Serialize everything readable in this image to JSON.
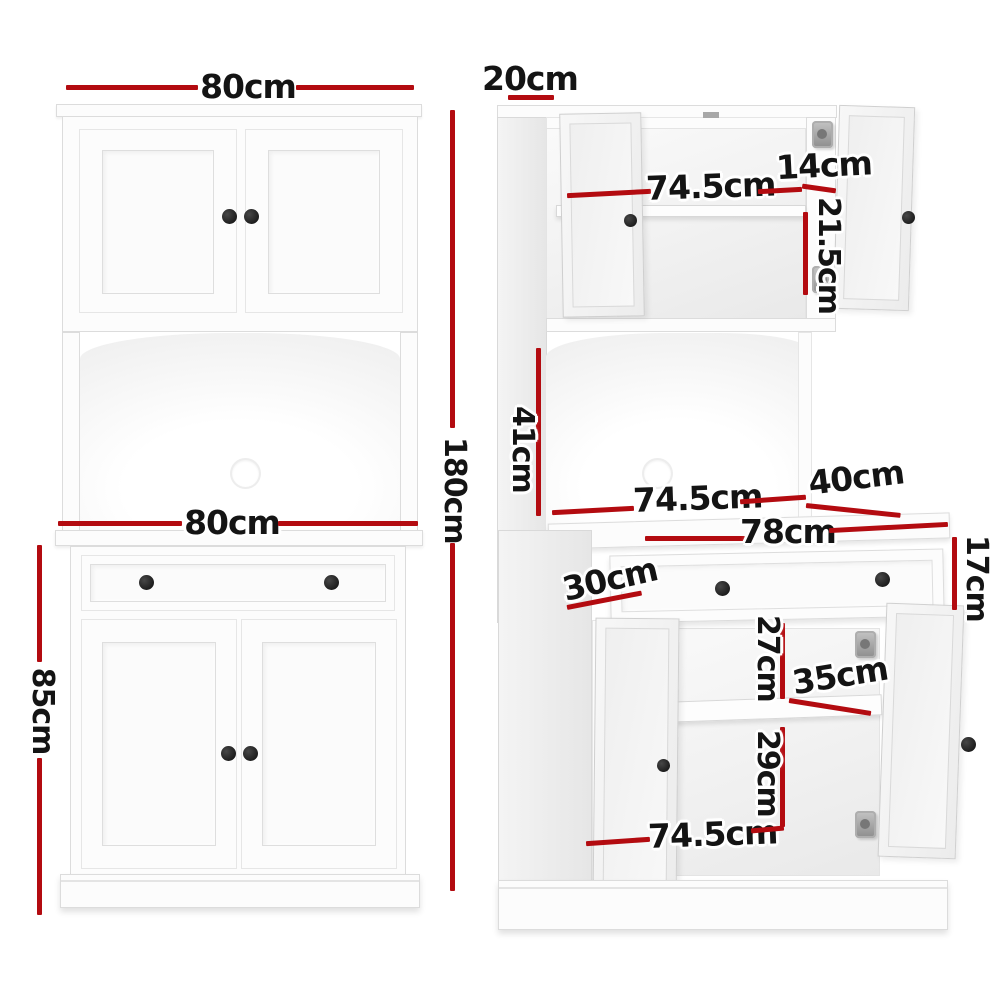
{
  "diagram": {
    "subject": "white buffet sideboard cabinet with hutch, shown as front elevation and three-quarter open view with dimensions",
    "views": {
      "front": "front-elevation",
      "side": "three-quarter-open-view"
    }
  },
  "palette": {
    "dimension_red": "#b30b10",
    "label_black": "#141414",
    "cabinet_white": "#fcfcfc",
    "edge_gray": "#dcdcdc",
    "knob_black": "#0c0c0c",
    "hinge_gray": "#8d8d8d"
  },
  "labels": {
    "front_top_width": "80cm",
    "front_total_height": "180cm",
    "front_counter_width": "80cm",
    "front_base_height": "85cm",
    "side_top_depth": "20cm",
    "hutch_inner_width": "74.5cm",
    "hutch_shelf_depth": "14cm",
    "hutch_shelf_height": "21.5cm",
    "alcove_height": "41cm",
    "alcove_inner_width": "74.5cm",
    "base_depth": "40cm",
    "bench_top_width": "78cm",
    "drawer_height": "17cm",
    "drawer_depth": "30cm",
    "shelf_space_upper": "27cm",
    "shelf_depth": "35cm",
    "shelf_space_lower": "29cm",
    "base_inner_width": "74.5cm"
  }
}
